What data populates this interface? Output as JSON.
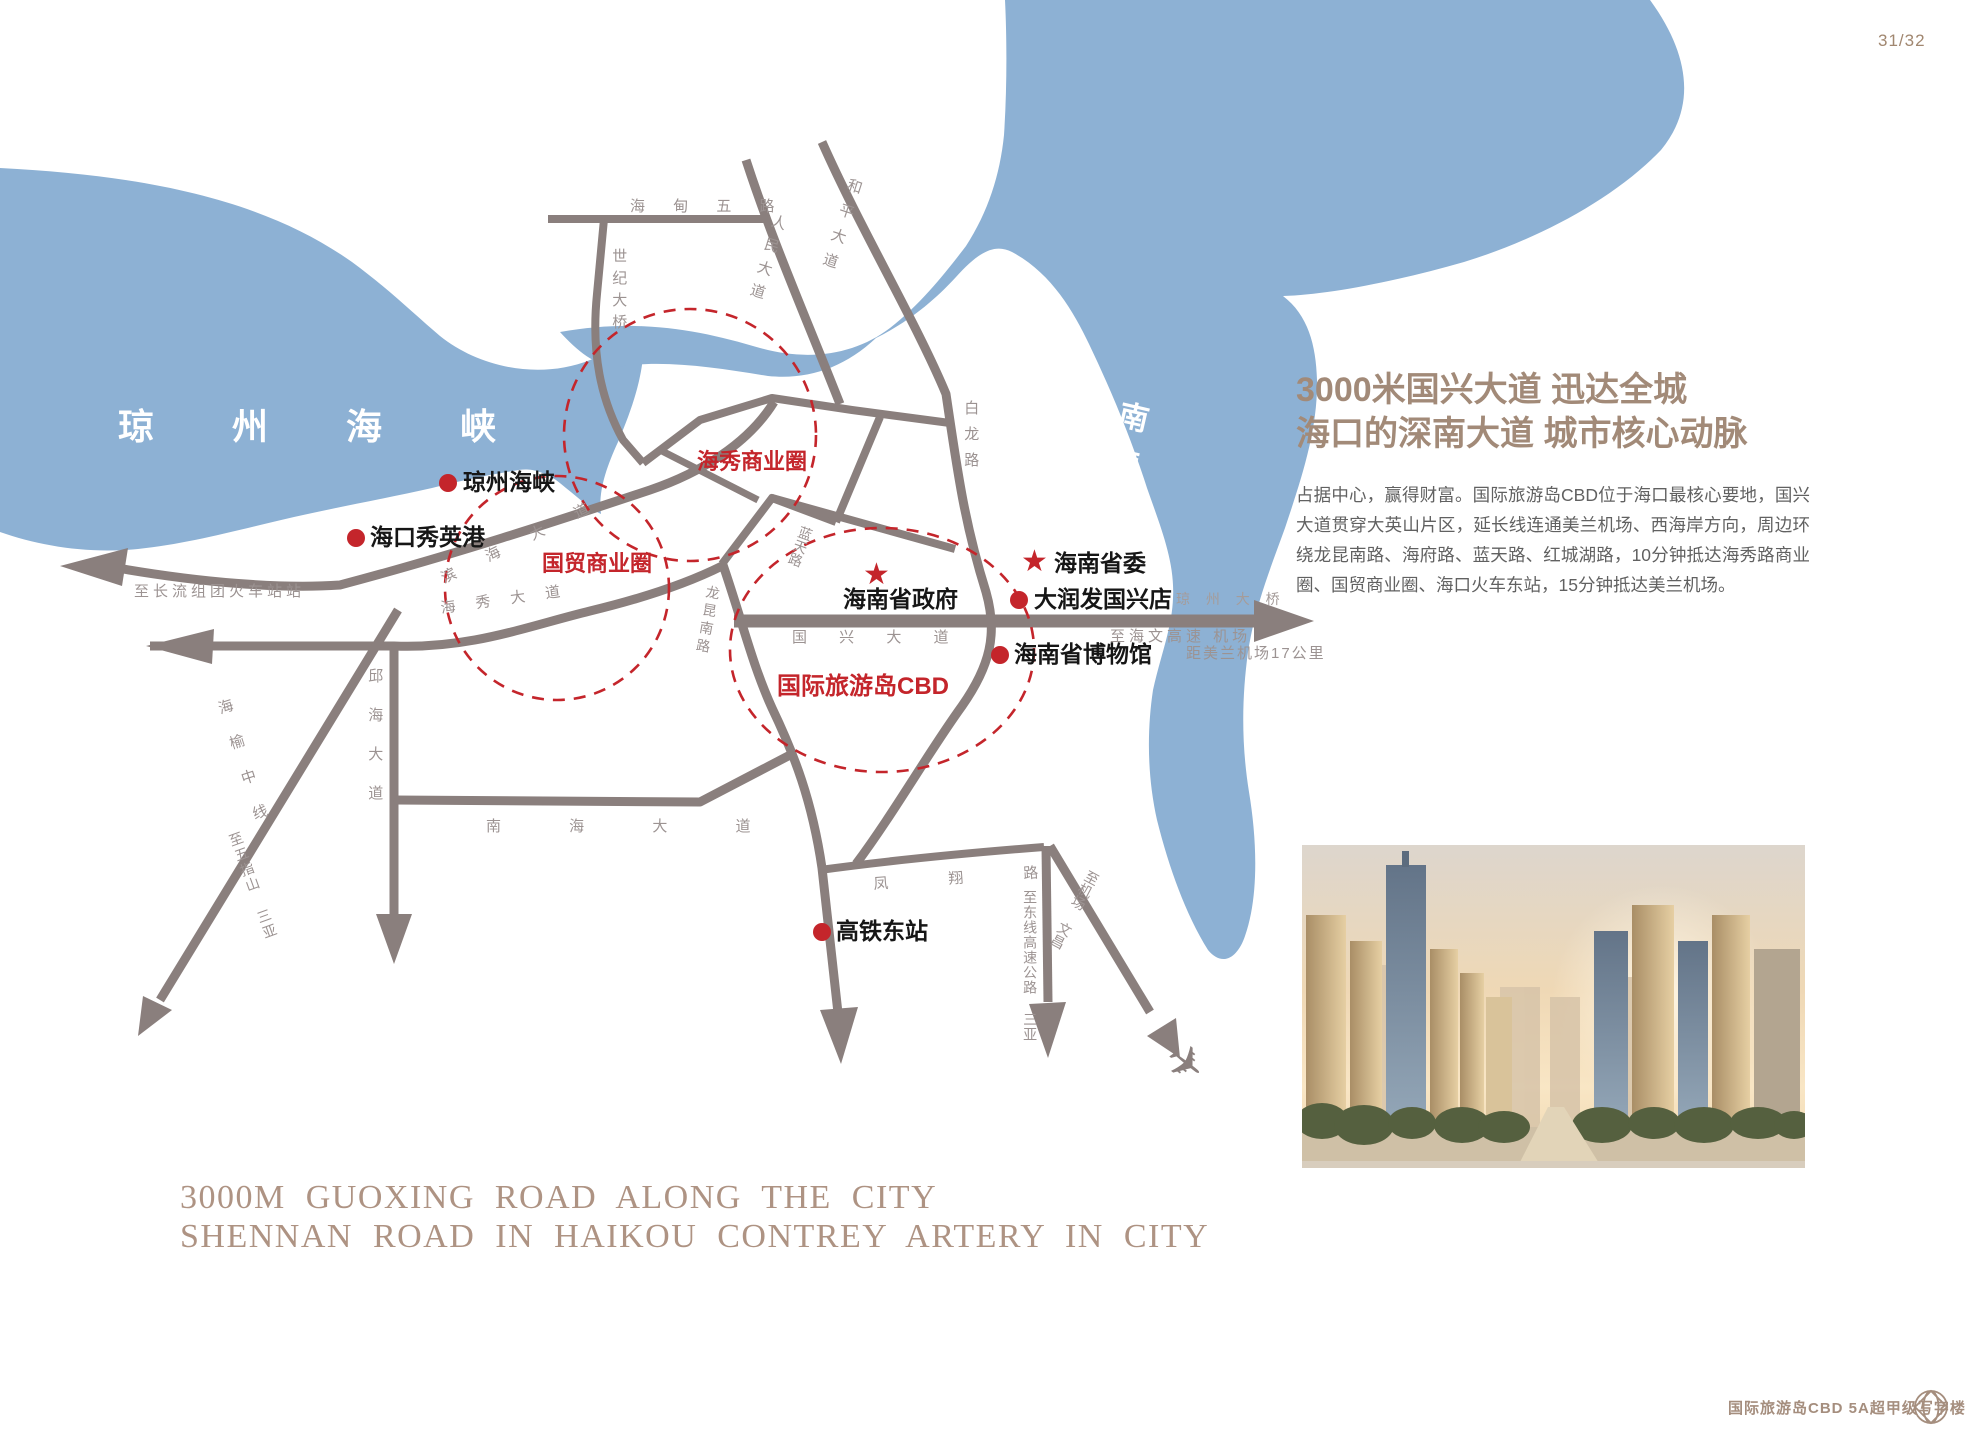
{
  "page": {
    "number": "31/32"
  },
  "map": {
    "sea": {
      "strait": "琼 州 海 峡",
      "river": "南渡江"
    },
    "roads": {
      "haidian5": "海 甸 五 路",
      "shiji_bridge": "世纪大桥",
      "renmin": "人民大道",
      "heping": "和平大道",
      "bailong": "白龙路",
      "nanhai": "南 海 大 道",
      "guoxing": "国 兴 大 道",
      "binhai": "滨 海 大 道",
      "haixiu": "海 秀 大 道",
      "qiuhai": "邱海大道",
      "haiyu": "海榆中线",
      "to_wuzhishan": "至五指山 三亚",
      "to_changliu": "至长流组团火车站站",
      "lantian": "蓝天路",
      "longkun": "龙昆南路",
      "fengxiang": "凤 翔 路",
      "to_dongxian": "至东线高速公路 三亚",
      "to_airport": "至机场 文昌",
      "qiongzhou_bridge": "琼 州 大 桥",
      "to_haiwen": "至海文高速 机场",
      "meilan_distance": "距美兰机场17公里"
    },
    "circles": [
      {
        "label": "海秀商业圈"
      },
      {
        "label": "国贸商业圈"
      },
      {
        "label": "国际旅游岛CBD"
      }
    ],
    "landmarks": [
      {
        "label": "琼州海峡",
        "marker": "dot"
      },
      {
        "label": "海口秀英港",
        "marker": "dot"
      },
      {
        "label": "海南省政府",
        "marker": "star"
      },
      {
        "label": "海南省委",
        "marker": "star"
      },
      {
        "label": "大润发国兴店",
        "marker": "dot"
      },
      {
        "label": "海南省博物馆",
        "marker": "dot"
      },
      {
        "label": "高铁东站",
        "marker": "dot"
      }
    ]
  },
  "aside": {
    "title_line1": "3000米国兴大道  迅达全城",
    "title_line2": "海口的深南大道  城市核心动脉",
    "body": "占据中心，赢得财富。国际旅游岛CBD位于海口最核心要地，国兴大道贯穿大英山片区，延长线连通美兰机场、西海岸方向，周边环绕龙昆南路、海府路、蓝天路、红城湖路，10分钟抵达海秀路商业圈、国贸商业圈、海口火车东站，15分钟抵达美兰机场。"
  },
  "heading": {
    "line1": "3000M GUOXING ROAD ALONG THE CITY",
    "line2": "SHENNAN ROAD IN HAIKOU CONTREY ARTERY IN CITY"
  },
  "footer": {
    "brand": "国际旅游岛CBD  5A超甲级写字楼"
  },
  "colors": {
    "sea": "#8db1d4",
    "road": "#8a7f7d",
    "accent_red": "#c4252b",
    "brand_brown": "#a58e7e"
  }
}
